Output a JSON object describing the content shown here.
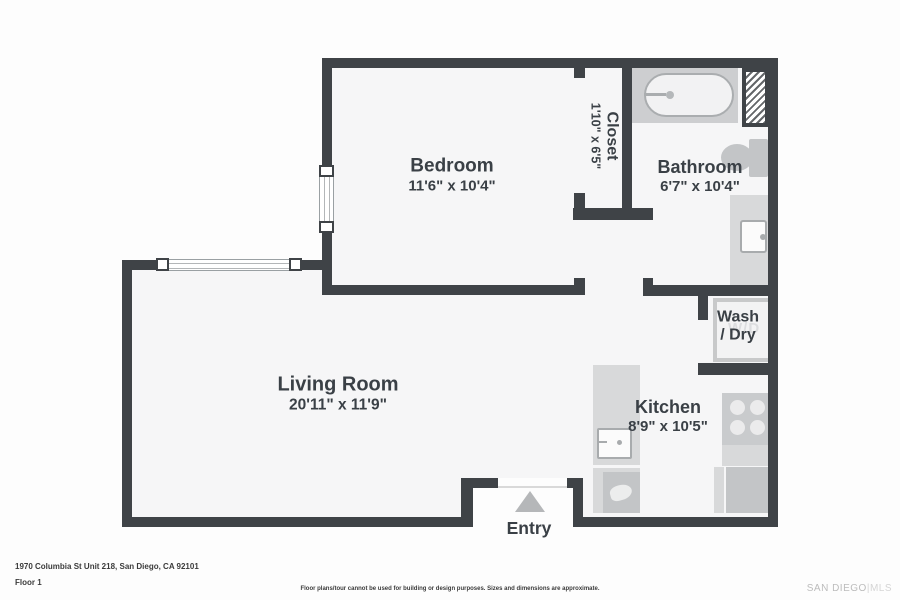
{
  "plan": {
    "rooms": {
      "bedroom": {
        "name": "Bedroom",
        "dims": "11'6\" x 10'4\""
      },
      "closet": {
        "name": "Closet",
        "dims": "1'10\" x 6'5\""
      },
      "bathroom": {
        "name": "Bathroom",
        "dims": "6'7\" x 10'4\""
      },
      "living_room": {
        "name": "Living Room",
        "dims": "20'11\" x 11'9\""
      },
      "kitchen": {
        "name": "Kitchen",
        "dims": "8'9\" x 10'5\""
      },
      "wash_dry": {
        "line1": "Wash",
        "line2": "/ Dry"
      },
      "entry": {
        "name": "Entry"
      }
    },
    "appliance_labels": {
      "washer_dryer": "W/D"
    }
  },
  "footer": {
    "address": "1970 Columbia St Unit 218, San Diego, CA 92101",
    "floor": "Floor 1",
    "disclaimer": "Floor plans/tour cannot be used for building or design purposes. Sizes and dimensions are approximate.",
    "watermark_primary": "SAN DIEGO",
    "watermark_divider": "|",
    "watermark_secondary": "MLS"
  },
  "colors": {
    "wall": "#3f4347",
    "room_fill": "#f6f6f7",
    "page_background": "#fdfdfd",
    "label_text": "#3a4046",
    "fixture_light": "#d8d9da",
    "fixture_mid": "#c3c5c7",
    "tub_deck": "#cdced0",
    "entry_arrow": "#b5b7b9",
    "watermark": "#bcbcbc"
  }
}
